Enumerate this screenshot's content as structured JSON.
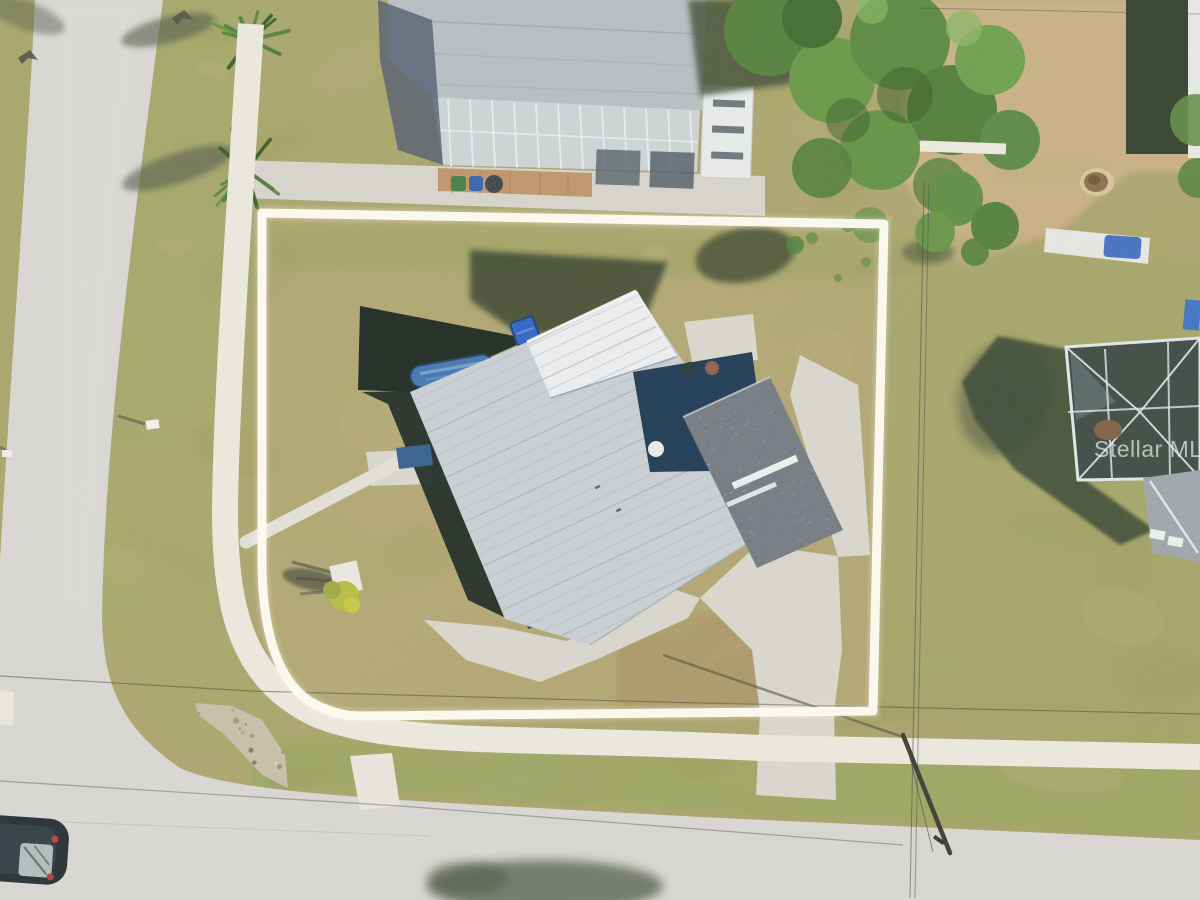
{
  "watermark": {
    "text": "Stellar MLS"
  },
  "colors": {
    "outer_grass": "#a6a566",
    "lot_grass": "#b4a571",
    "dirt": "#c9ae82",
    "road": "#d7d6d2",
    "sidewalk": "#ebe9dd",
    "concrete": "#d9d6cc",
    "boundary": "#fffdf2",
    "metal_roof": "#c9ced3",
    "bright_panel": "#eceef0",
    "shingle_roof": "#70777d",
    "lanai": "#16334d",
    "pool_cage": "#17221b",
    "pool_water": "#3e72b2",
    "spa_cover": "#2b5ec6",
    "watermark_text": "#ffffff"
  }
}
